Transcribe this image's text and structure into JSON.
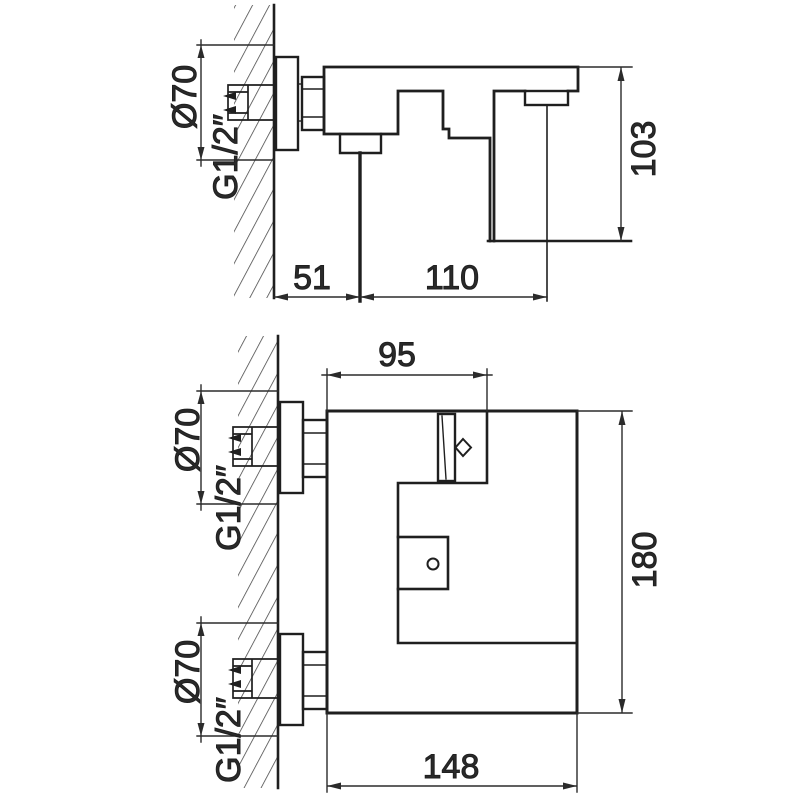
{
  "colors": {
    "background": "#ffffff",
    "line": "#1f1f1f"
  },
  "side_view": {
    "escutcheon_diameter": "Ø70",
    "thread_size": "G1/2″",
    "dim_height": "103",
    "dim_wall_to_handle": "51",
    "dim_handle_to_outlet": "110"
  },
  "front_view": {
    "dim_top_width": "95",
    "dim_height": "180",
    "dim_width": "148",
    "top_connection": {
      "diameter": "Ø70",
      "thread": "G1/2″"
    },
    "bottom_connection": {
      "diameter": "Ø70",
      "thread": "G1/2″"
    }
  }
}
